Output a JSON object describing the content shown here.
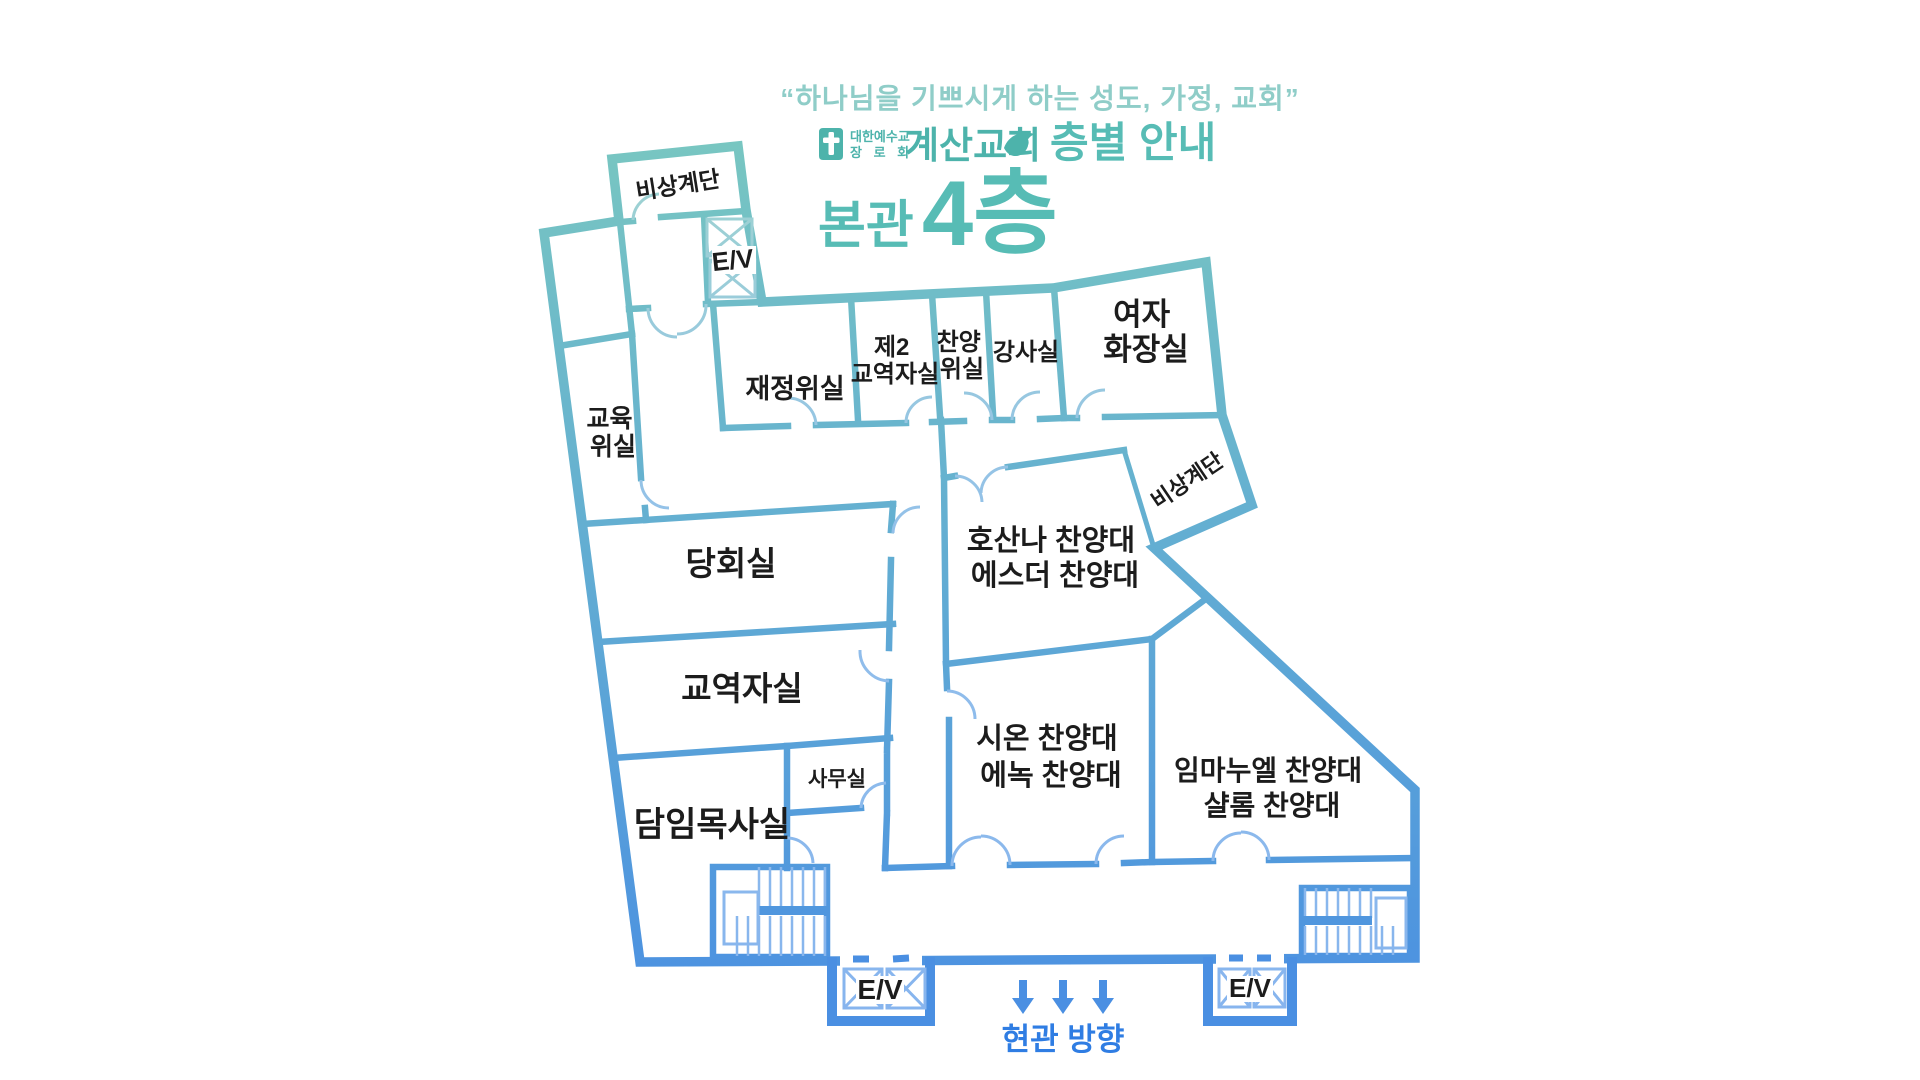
{
  "header": {
    "quote": "“하나님을 기쁘시게 하는 성도, 가정, 교회”",
    "denomination": {
      "line1": "대한예수교",
      "line2": "장 로 회"
    },
    "church_name": "계산교회",
    "guide_label": "층별 안내",
    "title": {
      "building": "본관",
      "floor": "4층"
    }
  },
  "colors": {
    "wall_teal_top": "#74c5c0",
    "wall_blue_bottom": "#4a8fe2",
    "accent_teal": "#57bcb5",
    "brand_teal": "#4db3ab",
    "quote_teal": "#8fcdc8",
    "entrance_blue": "#2f7de3",
    "label_black": "#1c1c1c",
    "detail_light": "#8ab9ea"
  },
  "rooms": {
    "emergency_stair_top": "비상계단",
    "emergency_stair_side": "비상계단",
    "elevator_top": "E/V",
    "elevator_bottom_left": "E/V",
    "elevator_bottom_right": "E/V",
    "education_committee": {
      "line1": "교육",
      "line2": "위실"
    },
    "finance_committee": "재정위실",
    "second_ministers": {
      "line1": "제2",
      "line2": "교역자실"
    },
    "praise_committee": {
      "line1": "찬양",
      "line2": "위실"
    },
    "instructor_room": "강사실",
    "womens_restroom": {
      "line1": "여자",
      "line2": "화장실"
    },
    "session_room": "당회실",
    "ministers_room": "교역자실",
    "office": "사무실",
    "senior_pastor_room": "담임목사실",
    "hosanna_esther": {
      "line1": "호산나 찬양대",
      "line2": "에스더 찬양대"
    },
    "zion_enoch": {
      "line1": "시온 찬양대",
      "line2": "에녹 찬양대"
    },
    "immanuel_shalom": {
      "line1": "임마누엘 찬양대",
      "line2": "샬롬 찬양대"
    }
  },
  "footer": {
    "entrance_direction": "현관 방향"
  }
}
